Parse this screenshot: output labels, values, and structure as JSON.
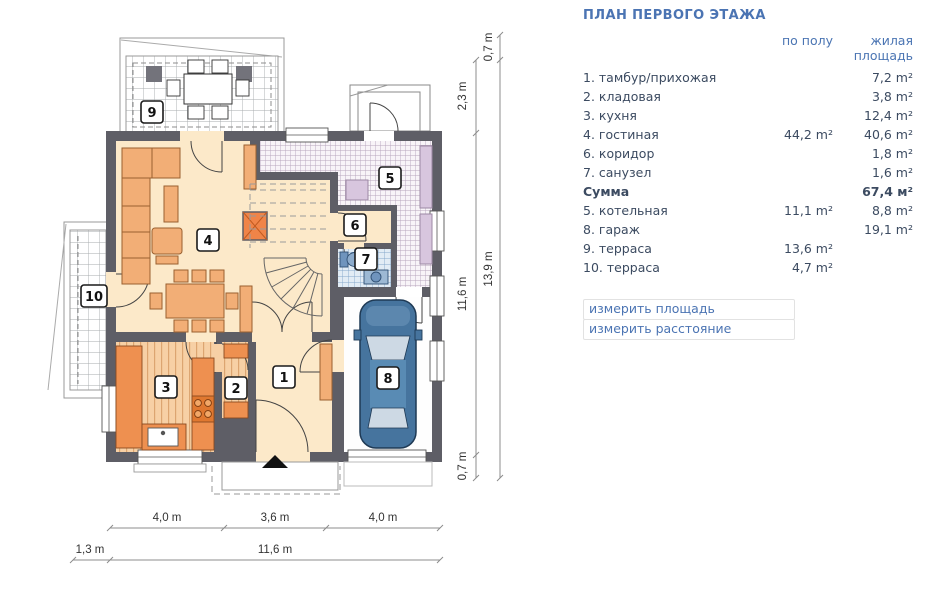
{
  "panel": {
    "title": "ПЛАН ПЕРВОГО ЭТАЖА",
    "columns": {
      "floor": "по полу",
      "living": "жилая площадь"
    },
    "rows": [
      {
        "name": "1. тамбур/прихожая",
        "floor": "",
        "living": "7,2 m²"
      },
      {
        "name": "2. кладовая",
        "floor": "",
        "living": "3,8 m²"
      },
      {
        "name": "3. кухня",
        "floor": "",
        "living": "12,4 m²"
      },
      {
        "name": "4. гостиная",
        "floor": "44,2 m²",
        "living": "40,6 m²"
      },
      {
        "name": "6. коридор",
        "floor": "",
        "living": "1,8 m²"
      },
      {
        "name": "7. санузел",
        "floor": "",
        "living": "1,6 m²"
      },
      {
        "name": "Сумма",
        "floor": "",
        "living": "67,4 м²"
      },
      {
        "name": "5. котельная",
        "floor": "11,1 m²",
        "living": "8,8 m²"
      },
      {
        "name": "8. гараж",
        "floor": "",
        "living": "19,1 m²"
      },
      {
        "name": "9. терраса",
        "floor": "13,6 m²",
        "living": ""
      },
      {
        "name": "10. терраса",
        "floor": "4,7 m²",
        "living": ""
      }
    ],
    "links": [
      "измерить площадь",
      "измерить расстояние"
    ]
  },
  "plan": {
    "room_labels": [
      "1",
      "2",
      "3",
      "4",
      "5",
      "6",
      "7",
      "8",
      "9",
      "10"
    ],
    "dimensions": {
      "right_inner": [
        "2,3 m",
        "11,6 m",
        "0,7 m"
      ],
      "right_outer": [
        "0,7 m",
        "13,9 m"
      ],
      "bottom_segments": [
        "4,0 m",
        "3,6 m",
        "4,0 m"
      ],
      "bottom_total": [
        "1,3 m",
        "11,6 m"
      ]
    }
  },
  "colors": {
    "accent_blue": "#4b74b3",
    "wall_gray": "#5e5e66",
    "floor_cream": "#fce9c9",
    "furniture_orange": "#f2ae76",
    "counter_orange": "#ee9050",
    "car_blue": "#46749e",
    "lavender": "#d8c6de"
  }
}
